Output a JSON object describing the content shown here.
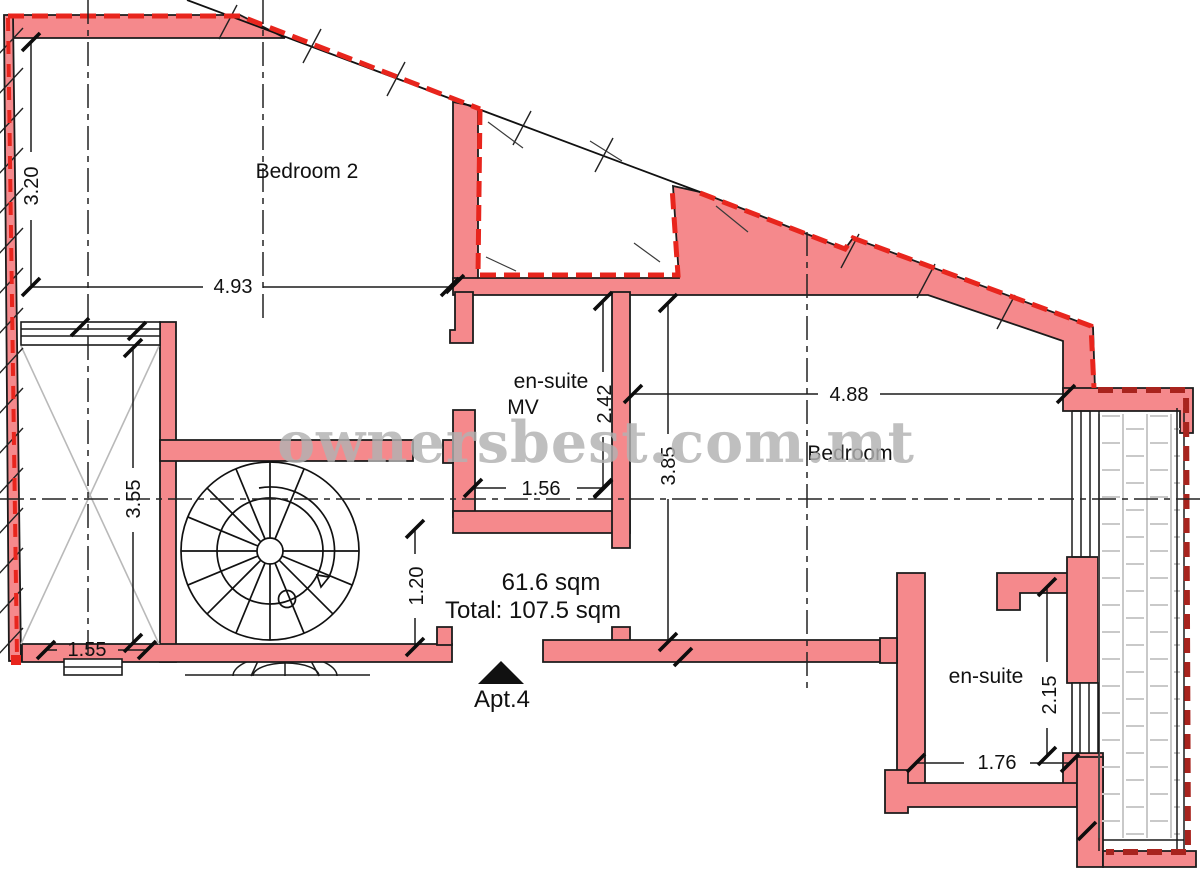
{
  "watermark": "ownersbest.com.mt",
  "rooms": {
    "bedroom2": "Bedroom 2",
    "ensuite_mv": {
      "line1": "en-suite",
      "line2": "MV"
    },
    "bedroom": "Bedroom",
    "ensuite": "en-suite"
  },
  "areas": {
    "apartment": "61.6 sqm",
    "total": "Total: 107.5 sqm"
  },
  "entrance_label": "Apt.4",
  "dimensions": {
    "bedroom2_height": "3.20",
    "bedroom2_width": "4.93",
    "shaft_height": "3.55",
    "shaft_width": "1.55",
    "corridor_width": "1.20",
    "ensuite_mv_width": "1.56",
    "ensuite_mv_height": "2.42",
    "bedroom_height": "3.85",
    "bedroom_width": "4.88",
    "ensuite_height": "2.15",
    "ensuite_width": "1.76"
  },
  "colors": {
    "wall_fill": "#f5898c",
    "boundary_red": "#e8251d",
    "boundary_dark_red": "#a8241e",
    "watermark_gray": "#b2b2b2",
    "tile_gray": "#c9c9c9"
  }
}
